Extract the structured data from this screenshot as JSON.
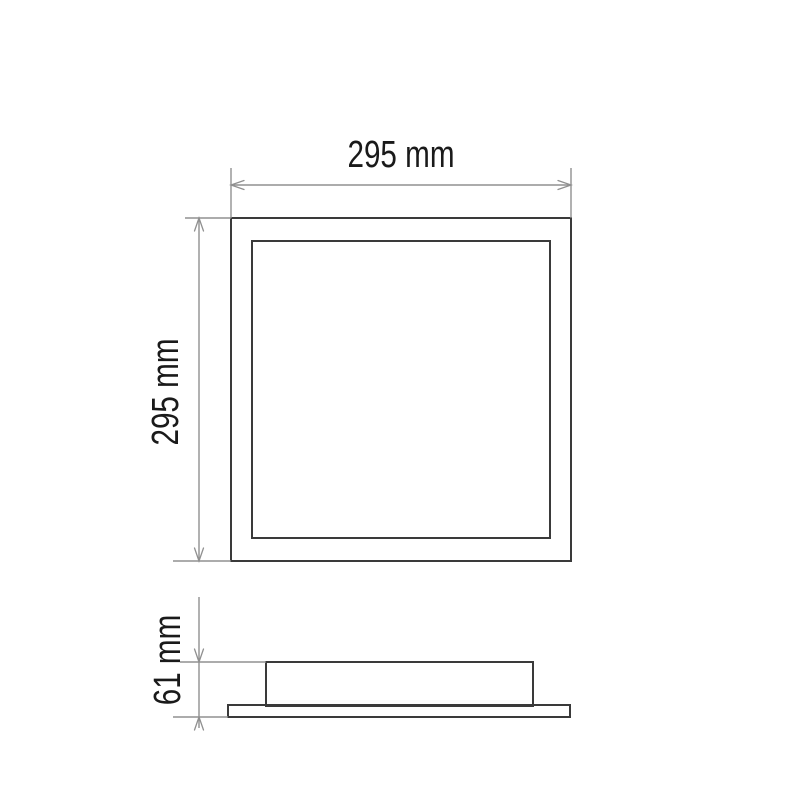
{
  "drawing": {
    "type": "technical-dimension-diagram",
    "dimensions": {
      "width": {
        "label": "295 mm",
        "value": 295,
        "unit": "mm"
      },
      "height": {
        "label": "295 mm",
        "value": 295,
        "unit": "mm"
      },
      "depth": {
        "label": "61 mm",
        "value": 61,
        "unit": "mm"
      }
    },
    "colors": {
      "background": "#ffffff",
      "object_line": "#3a3a3a",
      "dimension_line": "#909090",
      "label_text": "#1a1a1a"
    }
  }
}
